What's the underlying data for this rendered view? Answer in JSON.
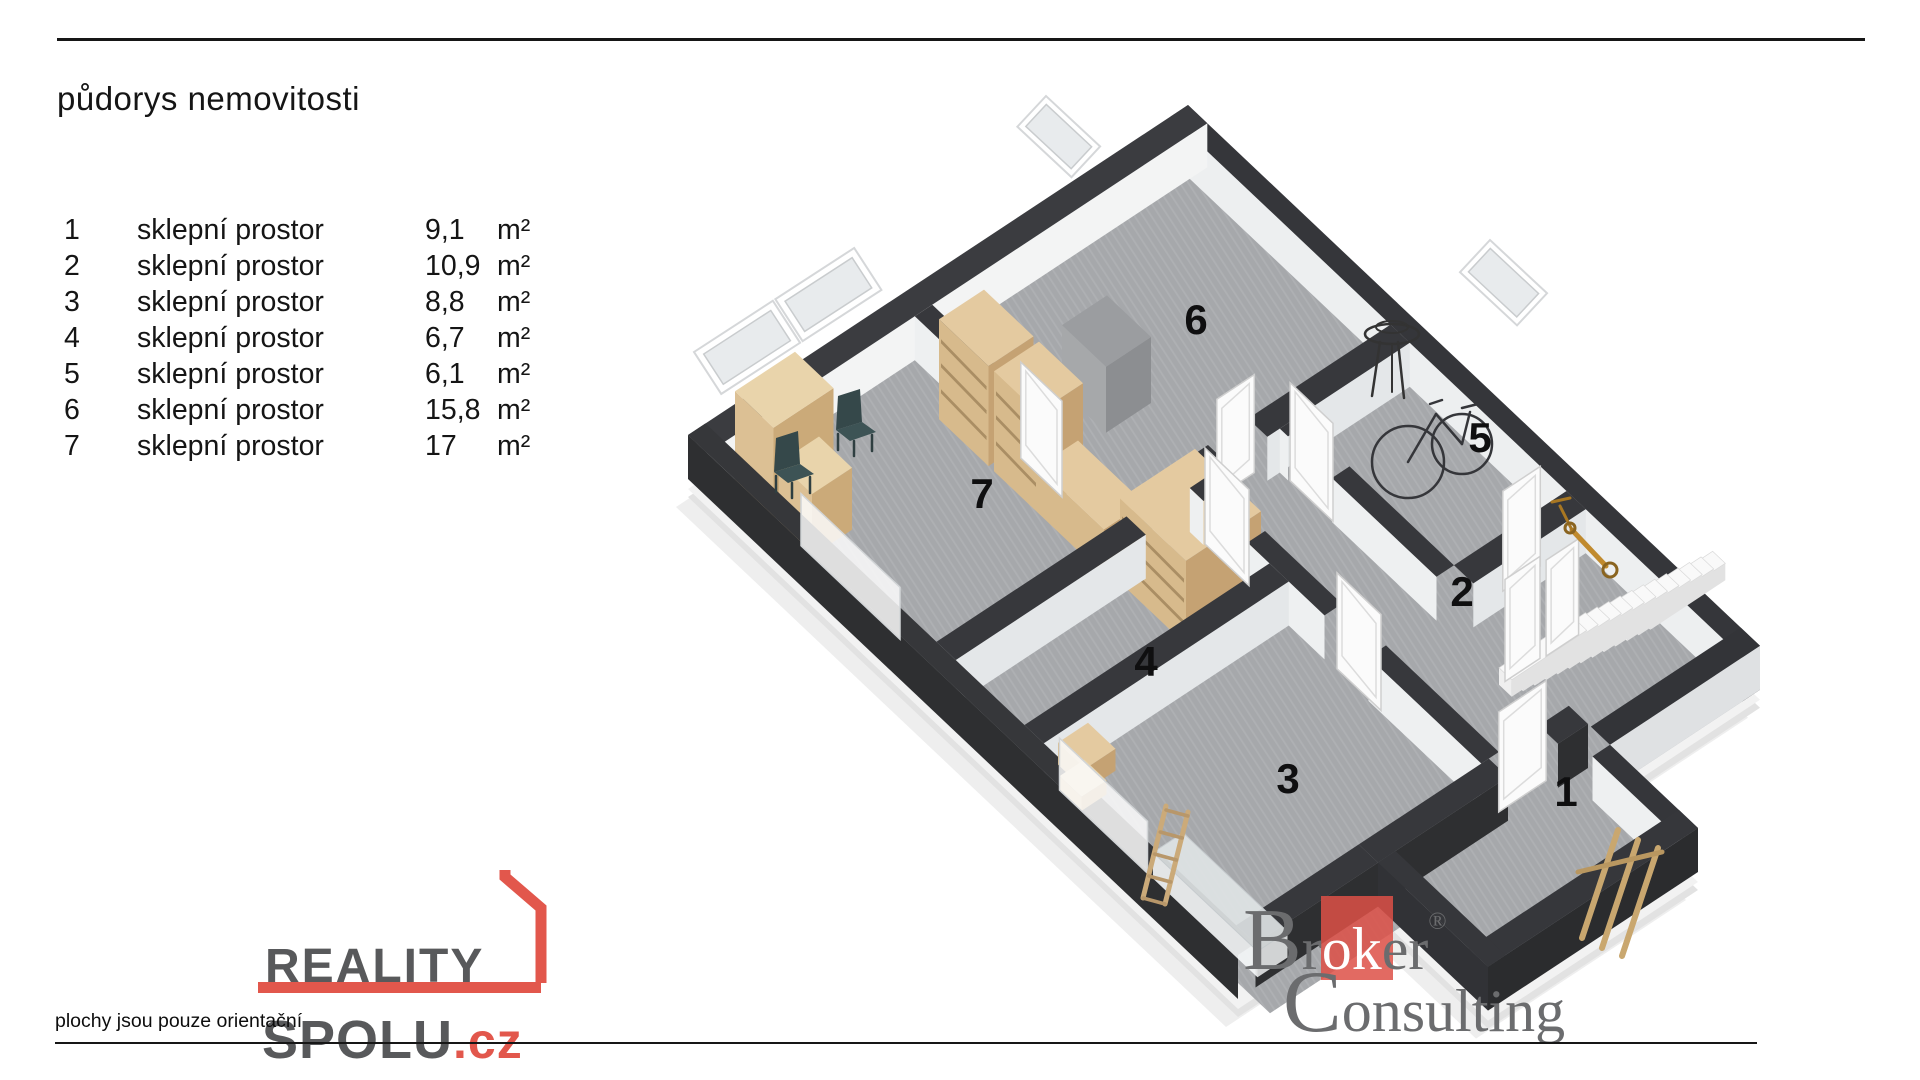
{
  "header": {
    "title": "půdorys nemovitosti"
  },
  "legend": {
    "unit": "m²",
    "rows": [
      {
        "num": "1",
        "name": "sklepní prostor",
        "area": "9,1"
      },
      {
        "num": "2",
        "name": "sklepní prostor",
        "area": "10,9"
      },
      {
        "num": "3",
        "name": "sklepní prostor",
        "area": "8,8"
      },
      {
        "num": "4",
        "name": "sklepní prostor",
        "area": "6,7"
      },
      {
        "num": "5",
        "name": "sklepní prostor",
        "area": "6,1"
      },
      {
        "num": "6",
        "name": "sklepní prostor",
        "area": "15,8"
      },
      {
        "num": "7",
        "name": "sklepní prostor",
        "area": "17"
      }
    ]
  },
  "floorplan": {
    "wall_color": "#36373a",
    "floor_color": "#a6a8ab",
    "wood_color": "#d8bd92",
    "rooms": [
      {
        "number": "1",
        "x": 1566,
        "y": 806
      },
      {
        "number": "2",
        "x": 1462,
        "y": 606
      },
      {
        "number": "3",
        "x": 1288,
        "y": 793
      },
      {
        "number": "4",
        "x": 1146,
        "y": 676
      },
      {
        "number": "5",
        "x": 1480,
        "y": 452
      },
      {
        "number": "6",
        "x": 1196,
        "y": 334
      },
      {
        "number": "7",
        "x": 982,
        "y": 508
      }
    ]
  },
  "branding": {
    "reality_spolu": {
      "line1": "REALITY",
      "line2": "SPOLU",
      "tld": ".cz",
      "accent": "#e2574c",
      "text_color": "#58595b"
    },
    "broker": {
      "word1_big": "B",
      "word1_rest1": "r",
      "word1_white": "ok",
      "word1_rest2": "er",
      "registered": "®",
      "word2_big": "C",
      "word2_rest": "onsulting",
      "red": "#dd5046",
      "gray": "#6b6c6e"
    }
  },
  "footer": {
    "disclaimer": "plochy jsou pouze orientační"
  }
}
